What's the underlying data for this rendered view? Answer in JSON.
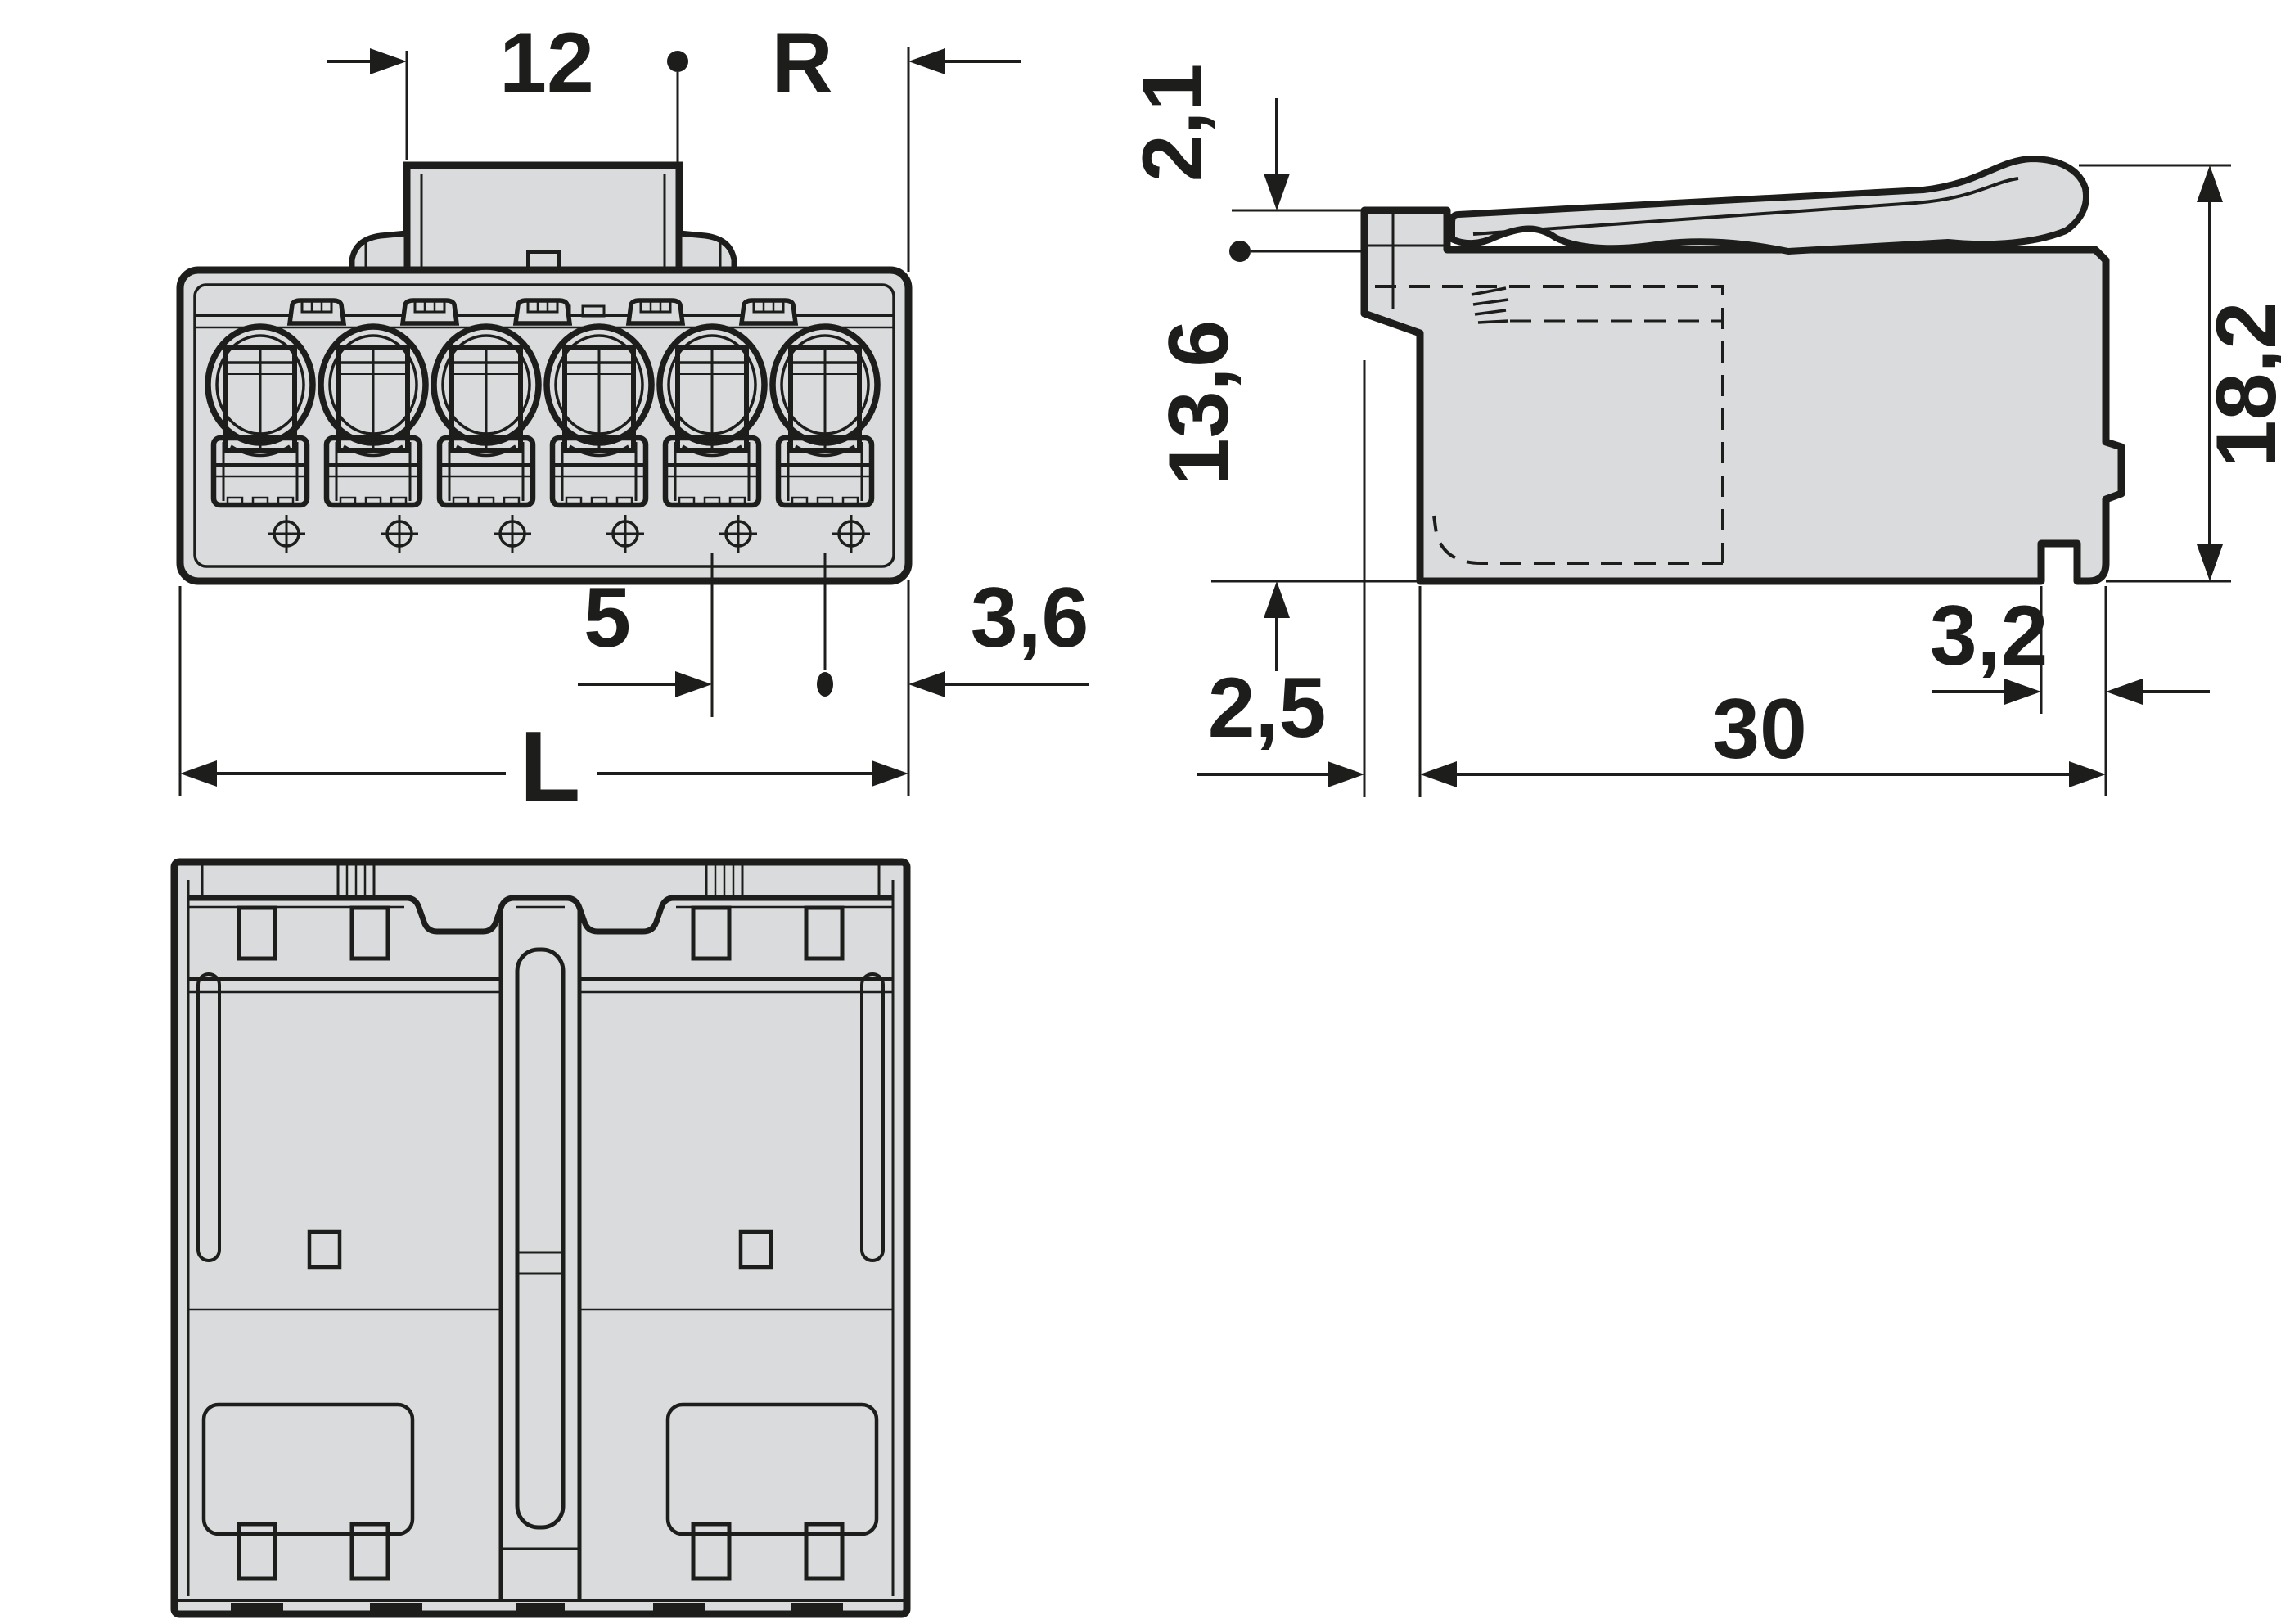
{
  "drawing_title": "6-pole plug connector dimensional drawing",
  "colors": {
    "background": "#ffffff",
    "body_fill": "#d9dbdd",
    "line": "#1d1d1b"
  },
  "views": {
    "front": {
      "label": "front-view",
      "poles": 6,
      "dimensions": {
        "top_width": "12",
        "right_ref": "R",
        "pitch": "5",
        "edge_offset": "3,6",
        "total_length": "L"
      }
    },
    "side": {
      "label": "side-view",
      "dimensions": {
        "lever_offset": "2,1",
        "front_depth": "13,6",
        "height": "18,2",
        "front_face": "2,5",
        "foot": "3,2",
        "depth": "30"
      }
    },
    "bottom": {
      "label": "bottom-view"
    }
  }
}
